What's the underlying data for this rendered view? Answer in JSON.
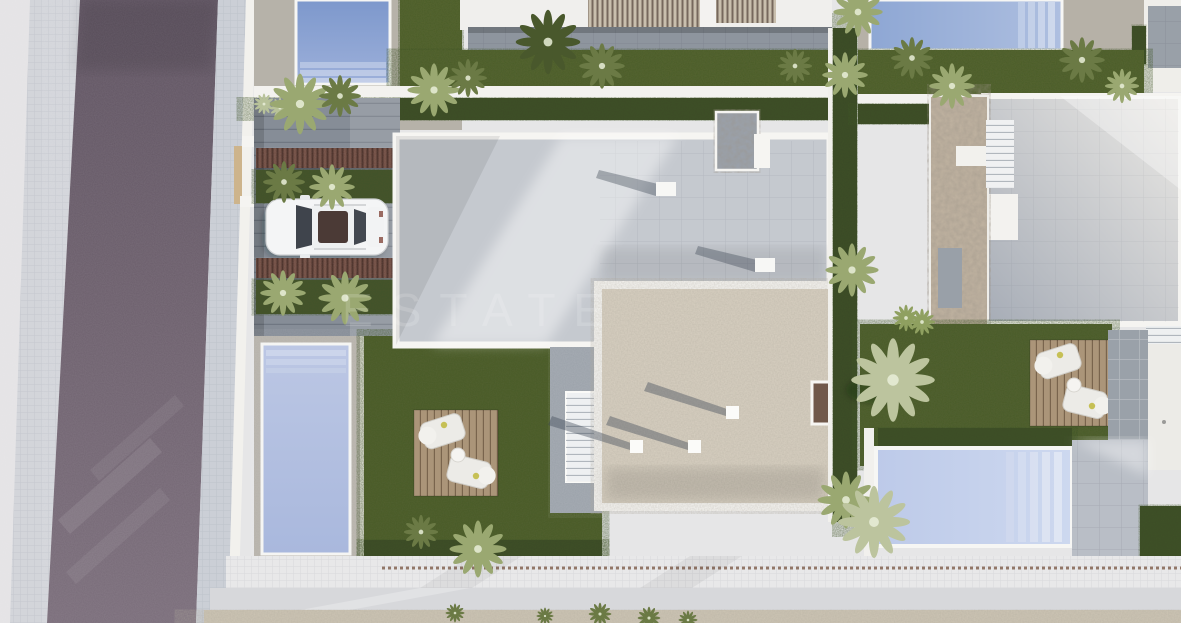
{
  "watermark": {
    "text": "ESTATE"
  },
  "scene": {
    "type": "aerial-3d-architectural-render",
    "description": "Top-down day render of a row of modern villas with flat roofs, gardens, pools and a street on the left",
    "objects": [
      {
        "name": "road",
        "label": "asphalt street"
      },
      {
        "name": "west-sidewalk",
        "label": "sidewalk left of street"
      },
      {
        "name": "east-sidewalk",
        "label": "sidewalk right of street"
      },
      {
        "name": "boundary-wall",
        "label": "white plot boundary wall"
      },
      {
        "name": "driveway",
        "label": "paved driveway of central villa"
      },
      {
        "name": "white-suv",
        "label": "white SUV parked in driveway"
      },
      {
        "name": "pergola",
        "label": "wooden pergola strip over planting bed"
      },
      {
        "name": "main-villa-roof",
        "label": "two-storey flat roof of central villa"
      },
      {
        "name": "roof-entry-block",
        "label": "stone entry volume at roof edge"
      },
      {
        "name": "roof-vent",
        "label": "white roof vent cube"
      },
      {
        "name": "gravel-roof",
        "label": "gravel flat roof of single-storey wing"
      },
      {
        "name": "roof-access-stairs",
        "label": "white side stairs"
      },
      {
        "name": "garden-pool-central",
        "label": "vertical pool of central villa"
      },
      {
        "name": "garden-lawn-central",
        "label": "lawn garden of central villa"
      },
      {
        "name": "sun-deck",
        "label": "timber deck with two loungers and table"
      },
      {
        "name": "neighbor-pool-top-left",
        "label": "pool of upper-left neighbor"
      },
      {
        "name": "neighbor-pool-top-right",
        "label": "pool of upper-right neighbor"
      },
      {
        "name": "right-villa-roof",
        "label": "flat roof of right villa"
      },
      {
        "name": "stone-feature-wall",
        "label": "travertine feature wall of right villa"
      },
      {
        "name": "right-villa-pool",
        "label": "horizontal pool of right villa"
      },
      {
        "name": "hedge",
        "label": "clipped dark hedges along walls"
      },
      {
        "name": "palm-tree",
        "label": "palm trees"
      },
      {
        "name": "south-walkway",
        "label": "white walkway along bottom"
      },
      {
        "name": "gravel-strip",
        "label": "beige gravel strip at bottom edge"
      }
    ],
    "palette": {
      "road": "#695c69",
      "sidewalk": "#cdd1d8",
      "grass": "#57662f",
      "hedge": "#3c4a26",
      "pool_water": "#9fb3dc",
      "pool_deck": "#b6b1a7",
      "roof_gray": "#c5c9cf",
      "gravel_roof": "#d8d0c1",
      "parapet_white": "#f6f5f2",
      "pergola_wood": "#6f4b40",
      "stone_wall": "#c0b3a1",
      "car_body": "#f4f5f6",
      "walkway": "#e8e8e9",
      "bottom_gravel": "#cdc5b4"
    }
  }
}
